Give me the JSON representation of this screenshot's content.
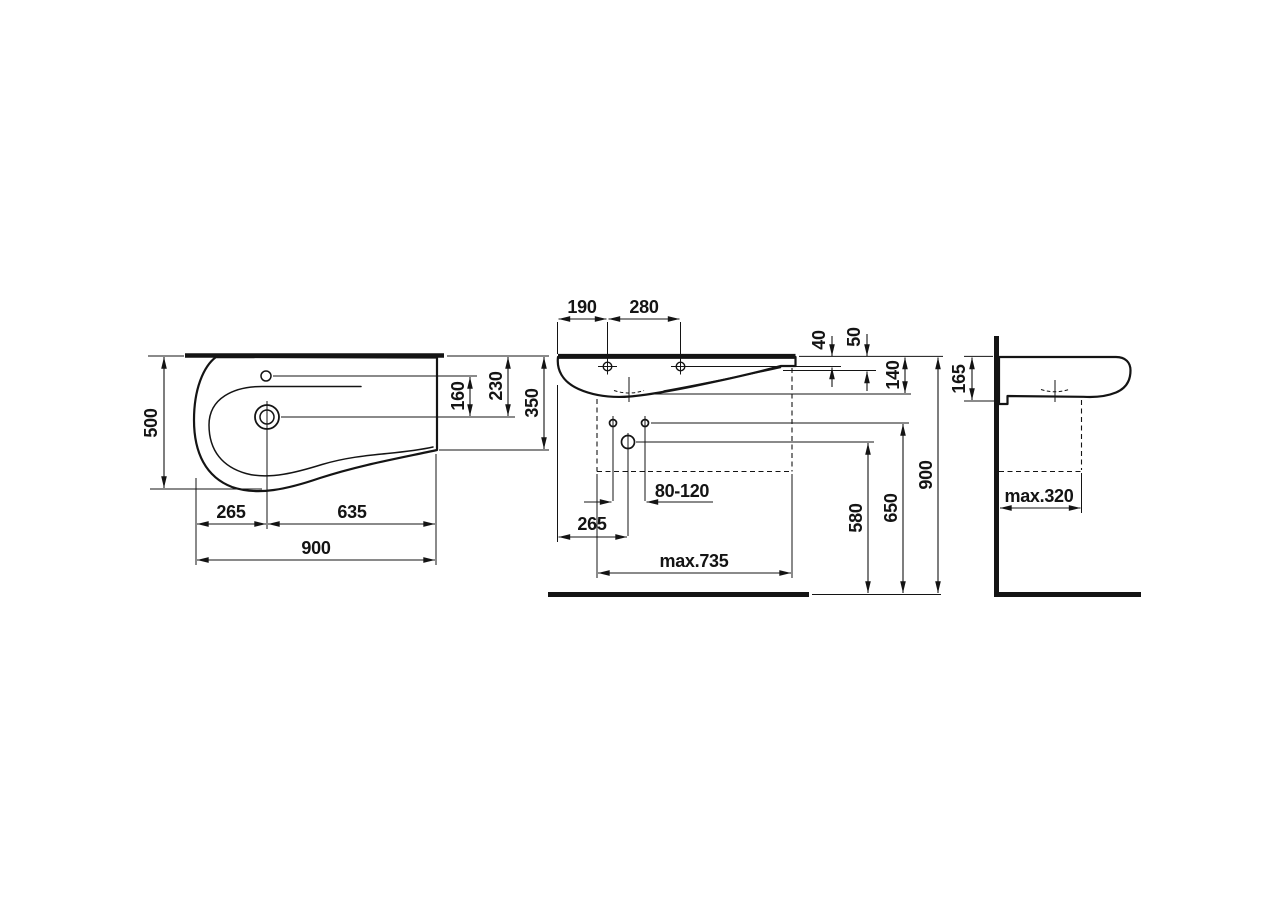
{
  "drawing": {
    "kind": "technical dimension drawing",
    "subject": "wall-hung washbasin, three orthographic views",
    "line_color": "#141414",
    "background_color": "#ffffff"
  },
  "views": {
    "plan": {
      "title": "top-view",
      "dims": {
        "depth": "500",
        "tap_to_drain": "160",
        "top_to_drain": "230",
        "right_depth": "350",
        "left_to_drain": "265",
        "drain_to_right": "635",
        "overall_width": "900"
      }
    },
    "front": {
      "title": "front-view",
      "dims": {
        "edge_to_tap": "190",
        "tap_spacing": "280",
        "top_to_tap_axis": "40",
        "top_to_edge": "50",
        "top_to_bottom": "140",
        "fixing_range": "80-120",
        "edge_to_drain": "265",
        "max_width": "max.735",
        "drain_height": "580",
        "fixing_height": "650",
        "rim_height": "900"
      }
    },
    "side": {
      "title": "side-view",
      "dims": {
        "rim_to_underside": "165",
        "max_depth": "max.320"
      }
    }
  }
}
